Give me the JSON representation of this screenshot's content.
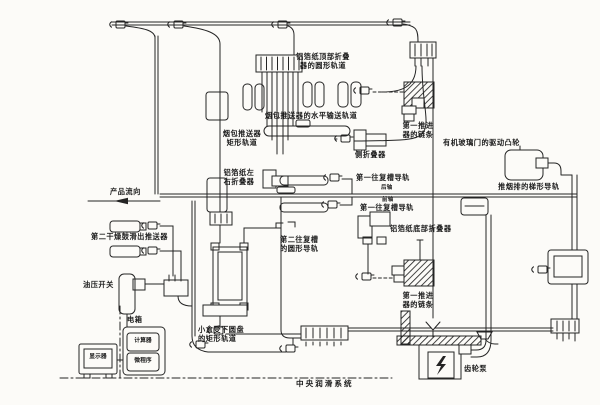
{
  "diagram": {
    "title": "中央润滑系统",
    "flow_arrow": "产品流向",
    "ink_color": "#242424",
    "bg_color": "#fcfbf8",
    "components": {
      "foil_top_folder_rail": "铝箔纸顶部折叠\n器的圆形轨道",
      "pack_pusher_horizontal_rail": "烟包推送器的水平输送轨道",
      "pack_pusher_rect_rail": "烟包推送器\n矩形轨道",
      "foil_left_right_folder": "铝箔纸左\n右折叠器",
      "side_folder": "侧折叠器",
      "first_pusher_chain_upper": "第一推进\n器的链条",
      "acrylic_door_drive_cam": "有机玻璃门的驱动凸轮",
      "first_recip_rail_rear": "第一往复槽导轨",
      "rear_axle_note": "后轴",
      "front_axle_note": "前轴",
      "first_recip_rail_front": "第一往复槽导轨",
      "push_row_trapezoid_rail": "推烟排的梯形导轨",
      "foil_bottom_folder": "铝箔纸底部折叠器",
      "second_recip_circular_rail": "第二往复槽\n的圆形导轨",
      "second_dryer_slideout_pusher": "第二干燥鼓滑出推送器",
      "oil_pressure_switch": "油压开关",
      "electric_box": "电箱",
      "computer": "计算器",
      "microprogram": "微程序",
      "monitor": "显示器",
      "small_box_disc_rect_rail": "小盒受下圆盘\n的矩形轨道",
      "first_pusher_chain_lower": "第一推进\n器的链条",
      "gear_pump": "齿轮泵"
    }
  }
}
